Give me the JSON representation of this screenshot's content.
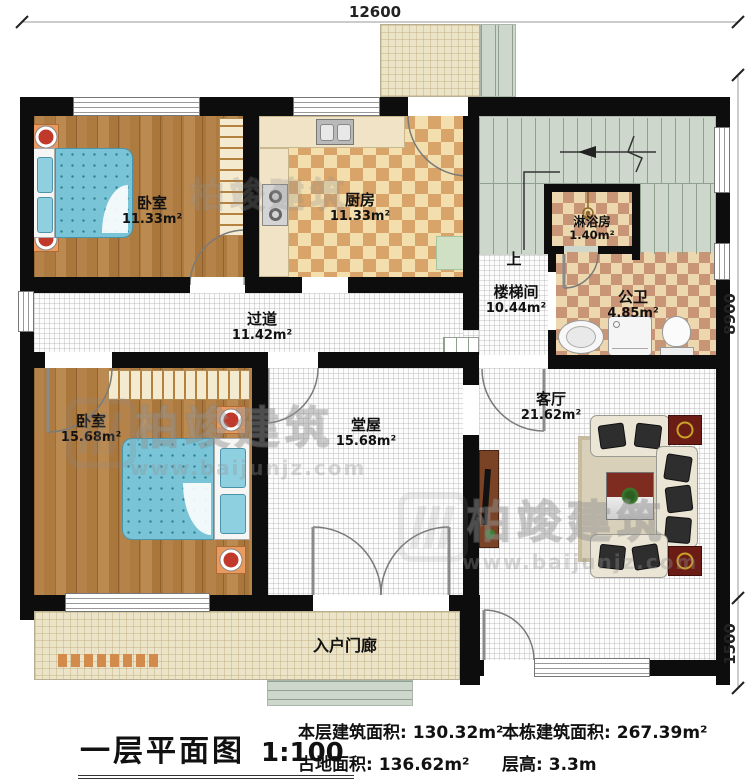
{
  "plan": {
    "dimensions": {
      "top_width": "12600",
      "right_height_main": "8900",
      "right_height_porch": "1500"
    },
    "rooms": {
      "bedroom1": {
        "name": "卧室",
        "area": "11.33m²"
      },
      "kitchen": {
        "name": "厨房",
        "area": "11.33m²"
      },
      "shower": {
        "name": "淋浴房",
        "area": "1.40m²"
      },
      "stair": {
        "name": "楼梯间",
        "area": "10.44m²",
        "up": "上"
      },
      "bathroom": {
        "name": "公卫",
        "area": "4.85m²"
      },
      "corridor": {
        "name": "过道",
        "area": "11.42m²"
      },
      "bedroom2": {
        "name": "卧室",
        "area": "15.68m²"
      },
      "hall": {
        "name": "堂屋",
        "area": "15.68m²"
      },
      "living": {
        "name": "客厅",
        "area": "21.62m²"
      },
      "porch": {
        "name": "入户门廊"
      }
    }
  },
  "footer": {
    "title": "一层平面图",
    "scale": "1:100",
    "stats": [
      {
        "label": "本层建筑面积:",
        "value": "130.32m²"
      },
      {
        "label": "占地面积:",
        "value": "136.62m²"
      },
      {
        "label": "本栋建筑面积:",
        "value": "267.39m²"
      },
      {
        "label": "层高:",
        "value": "3.3m"
      }
    ]
  },
  "watermark": {
    "brand": "柏竣建筑",
    "url": "www.baijunjz.com"
  },
  "colors": {
    "wall": "#0d0d0d",
    "wood": "#b5834a",
    "tile_cream": "#f3dfad",
    "tile_tan": "#d9a469",
    "bath_cream": "#ecd7ae",
    "bath_tan": "#c99577",
    "bed_blue": "#79c4d6",
    "stair_green": "#cdd7cc",
    "porch_cream": "#ece4c8",
    "maroon": "#7a241b",
    "accent_orange": "#e2965a"
  }
}
